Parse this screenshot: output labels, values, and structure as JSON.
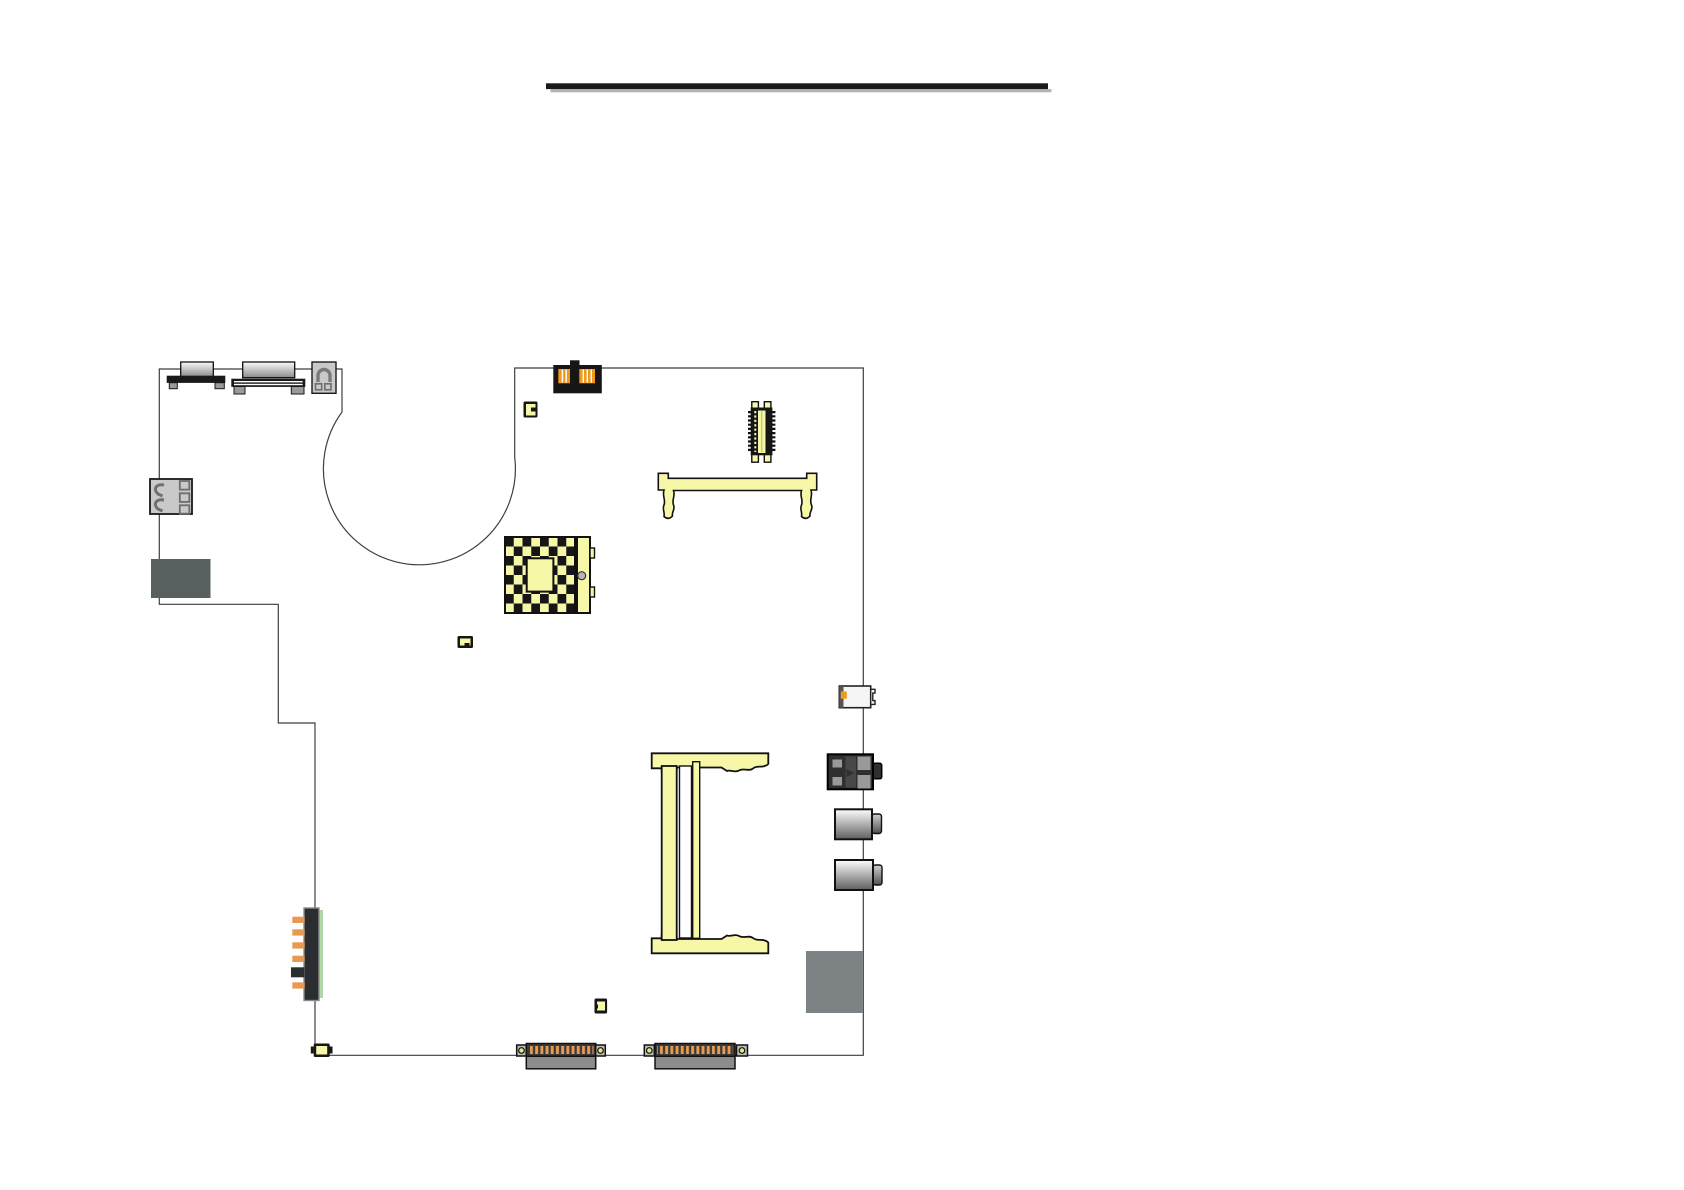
{
  "page": {
    "background": "#ffffff"
  },
  "title_rule": {
    "color": "#1a1a1a",
    "shadow_color": "#b3b3b3"
  },
  "colors": {
    "page_bg": "#ffffff",
    "pale_yellow": "#f7f7a8",
    "orange": "#f0991e",
    "pin_orange": "#e89a52",
    "part_black": "#161616",
    "dark_body": "#2b2e30",
    "slate_block": "#57605f",
    "shield_gray": "#7d8284",
    "light_gray_part": "#c9c9c9",
    "green_strip": "#b2d6a5",
    "hole_yellow": "#e8e87a",
    "outline": "#3f3f3f"
  },
  "components": [
    {
      "name": "title-underline"
    },
    {
      "name": "board-outline"
    },
    {
      "name": "serial-port"
    },
    {
      "name": "vga-port"
    },
    {
      "name": "power-connector"
    },
    {
      "name": "usb-ports"
    },
    {
      "name": "slate-block"
    },
    {
      "name": "dual-jack-connector"
    },
    {
      "name": "smd-component-a"
    },
    {
      "name": "lvds-connector"
    },
    {
      "name": "minipci-socket"
    },
    {
      "name": "cpu-socket"
    },
    {
      "name": "smd-component-b"
    },
    {
      "name": "ir-port"
    },
    {
      "name": "modem-jack"
    },
    {
      "name": "audio-jack-1"
    },
    {
      "name": "audio-jack-2"
    },
    {
      "name": "shield-block"
    },
    {
      "name": "memory-socket"
    },
    {
      "name": "battery-connector"
    },
    {
      "name": "smd-component-c"
    },
    {
      "name": "smd-component-d"
    },
    {
      "name": "docking-connector-1"
    },
    {
      "name": "docking-connector-2"
    }
  ]
}
